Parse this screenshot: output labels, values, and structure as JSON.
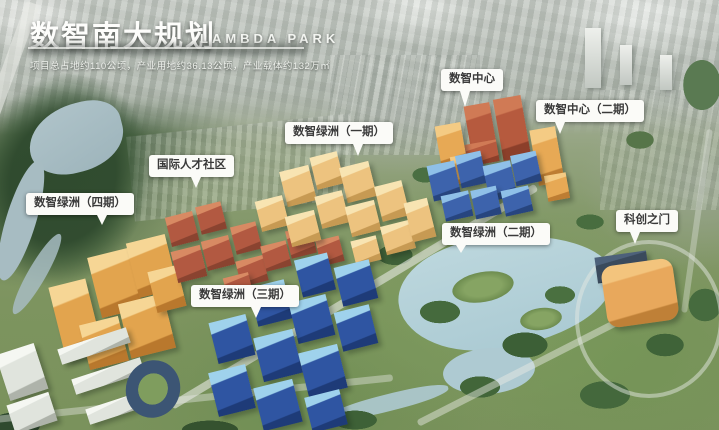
{
  "header": {
    "title": "数智南大规划",
    "subtitle_en": "LAMBDA PARK",
    "description": "项目总占地约110公顷，产业用地约36.13公顷，产业载体约132万㎡"
  },
  "palette": {
    "label_bg": "#fbfbf8",
    "label_text": "#3a3a3a",
    "title_color": "#fdfdfb",
    "water": "#b7d3da",
    "park_green": "#7c9b5d",
    "city_haze": "#c3c8c2"
  },
  "labels": [
    {
      "name": "label-digital-center",
      "text": "数智中心",
      "x": 441,
      "y": 69,
      "tailX": 38,
      "tailLen": 16
    },
    {
      "name": "label-digital-center-phase2",
      "text": "数智中心（二期）",
      "x": 536,
      "y": 100,
      "tailX": 22,
      "tailLen": 12
    },
    {
      "name": "label-oasis-phase1",
      "text": "数智绿洲（一期）",
      "x": 285,
      "y": 122,
      "tailX": 68,
      "tailLen": 12
    },
    {
      "name": "label-talent-community",
      "text": "国际人才社区",
      "x": 149,
      "y": 155,
      "tailX": 55,
      "tailLen": 11
    },
    {
      "name": "label-oasis-phase4",
      "text": "数智绿洲（四期）",
      "x": 26,
      "y": 193,
      "tailX": 70,
      "tailLen": 10
    },
    {
      "name": "label-oasis-phase2",
      "text": "数智绿洲（二期）",
      "x": 442,
      "y": 223,
      "tailX": 18,
      "tailLen": 8
    },
    {
      "name": "label-kechuang-gate",
      "text": "科创之门",
      "x": 616,
      "y": 210,
      "tailX": 30,
      "tailLen": 12
    },
    {
      "name": "label-oasis-phase3",
      "text": "数智绿洲（三期）",
      "x": 191,
      "y": 285,
      "tailX": 60,
      "tailLen": 11
    }
  ],
  "scene": {
    "clusters": [
      {
        "name": "oasis-phase4-gold",
        "top": "#f6d695",
        "body": "#e2a44e",
        "side": "#b9782d",
        "rotate": -14,
        "blocks": [
          [
            57,
            282,
            38,
            76
          ],
          [
            94,
            252,
            42,
            62
          ],
          [
            132,
            238,
            40,
            56
          ],
          [
            84,
            320,
            40,
            46
          ],
          [
            124,
            298,
            46,
            56
          ],
          [
            152,
            268,
            30,
            42
          ]
        ]
      },
      {
        "name": "talent-community-red",
        "top": "#d88a63",
        "body": "#b25941",
        "side": "#8a4330",
        "rotate": -14,
        "blocks": [
          [
            168,
            214,
            28,
            30
          ],
          [
            198,
            204,
            26,
            28
          ],
          [
            174,
            248,
            30,
            32
          ],
          [
            204,
            238,
            28,
            30
          ],
          [
            233,
            224,
            26,
            28
          ],
          [
            238,
            258,
            28,
            26
          ],
          [
            263,
            243,
            26,
            26
          ],
          [
            288,
            228,
            26,
            28
          ],
          [
            298,
            258,
            28,
            26
          ],
          [
            318,
            238,
            24,
            26
          ],
          [
            225,
            275,
            26,
            22
          ]
        ]
      },
      {
        "name": "oasis-phase1-tan",
        "top": "#f8e4b2",
        "body": "#edc37f",
        "side": "#c79a53",
        "rotate": -14,
        "blocks": [
          [
            283,
            168,
            30,
            36
          ],
          [
            313,
            154,
            28,
            33
          ],
          [
            343,
            164,
            30,
            36
          ],
          [
            258,
            198,
            28,
            31
          ],
          [
            288,
            213,
            30,
            31
          ],
          [
            318,
            193,
            28,
            33
          ],
          [
            348,
            203,
            30,
            31
          ],
          [
            378,
            183,
            28,
            36
          ],
          [
            383,
            223,
            30,
            29
          ],
          [
            353,
            238,
            26,
            25
          ],
          [
            408,
            200,
            24,
            40
          ]
        ]
      },
      {
        "name": "digital-center-red-towers",
        "top": "#d07a55",
        "body": "#b65a3e",
        "side": "#8c3f2a",
        "rotate": -10,
        "blocks": [
          [
            468,
            104,
            26,
            54
          ],
          [
            498,
            97,
            28,
            62
          ],
          [
            466,
            142,
            32,
            22
          ]
        ]
      },
      {
        "name": "digital-center-orange",
        "top": "#f4cb84",
        "body": "#e7a955",
        "side": "#bd7d33",
        "rotate": -10,
        "blocks": [
          [
            438,
            124,
            26,
            42
          ],
          [
            452,
            155,
            24,
            28
          ],
          [
            534,
            128,
            26,
            56
          ],
          [
            546,
            174,
            22,
            26
          ]
        ]
      },
      {
        "name": "oasis-phase2-blue",
        "top": "#8fc0e8",
        "body": "#3d63ac",
        "side": "#27457f",
        "rotate": -12,
        "blocks": [
          [
            430,
            163,
            28,
            36
          ],
          [
            458,
            153,
            26,
            33
          ],
          [
            486,
            163,
            28,
            36
          ],
          [
            513,
            153,
            26,
            31
          ],
          [
            443,
            193,
            28,
            26
          ],
          [
            473,
            188,
            26,
            29
          ],
          [
            503,
            188,
            28,
            26
          ]
        ]
      },
      {
        "name": "oasis-phase3-blue",
        "top": "#9fd2ec",
        "body": "#2f55a2",
        "side": "#1e3b78",
        "rotate": -14,
        "blocks": [
          [
            298,
            256,
            34,
            38
          ],
          [
            338,
            263,
            36,
            40
          ],
          [
            253,
            283,
            36,
            40
          ],
          [
            293,
            298,
            38,
            42
          ],
          [
            338,
            308,
            36,
            40
          ],
          [
            213,
            318,
            38,
            42
          ],
          [
            258,
            333,
            40,
            45
          ],
          [
            303,
            348,
            40,
            45
          ],
          [
            213,
            368,
            38,
            45
          ],
          [
            258,
            383,
            40,
            44
          ],
          [
            308,
            393,
            36,
            36
          ]
        ]
      },
      {
        "name": "kechuang-gate-podium",
        "top": "#4d617a",
        "body": "#3a4a5c",
        "side": "#2c3947",
        "rotate": -8,
        "blocks": [
          [
            596,
            254,
            52,
            26
          ]
        ]
      },
      {
        "name": "kechuang-gate-orange",
        "top": "#f3c47d",
        "body": "#e8a85c",
        "side": "#bf8037",
        "rotate": -8,
        "radius": 12,
        "blocks": [
          [
            604,
            262,
            72,
            62
          ]
        ]
      },
      {
        "name": "campus-gray",
        "top": "#f5f7f2",
        "body": "#e0e4dd",
        "side": "#aeb3aa",
        "rotate": -18,
        "blocks": [
          [
            2,
            348,
            40,
            48
          ],
          [
            10,
            398,
            44,
            30
          ],
          [
            58,
            338,
            72,
            16
          ],
          [
            72,
            368,
            72,
            16
          ],
          [
            86,
            398,
            72,
            16
          ]
        ]
      }
    ]
  }
}
